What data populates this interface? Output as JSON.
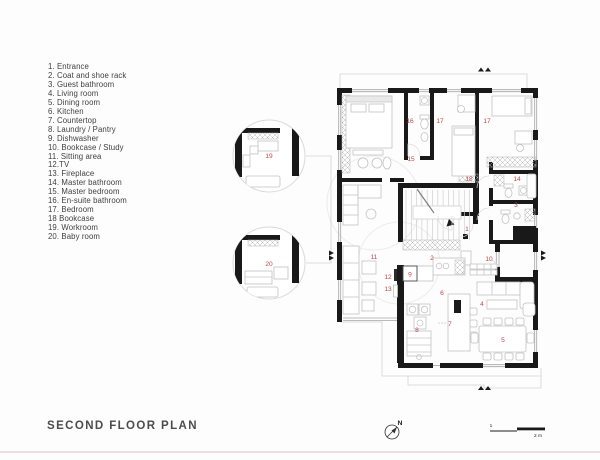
{
  "title": "SECOND FLOOR PLAN",
  "legend": {
    "items": [
      "1. Entrance",
      "2. Coat and shoe rack",
      "3. Guest bathroom",
      "4. Living room",
      "5. Dining room",
      "6. Kitchen",
      "7. Countertop",
      "8. Laundry / Pantry",
      "9. Dishwasher",
      "10. Bookcase / Study",
      "11. Sitting area",
      "12.TV",
      "13. Fireplace",
      "14. Master bathroom",
      "15. Master bedroom",
      "16. En-suite bathroom",
      "17. Bedroom",
      "18 Bookcase",
      "19. Workroom",
      "20. Baby room"
    ]
  },
  "plan": {
    "room_labels": {
      "entrance": "1",
      "coat_rack": "2",
      "guest_bath": "3",
      "living": "4",
      "dining": "5",
      "kitchen": "6",
      "countertop": "7",
      "laundry": "8",
      "dishwasher": "9",
      "bookcase_study": "10",
      "sitting": "11",
      "tv": "12",
      "fireplace": "13",
      "master_bath": "14",
      "master_bed": "15",
      "ensuite": "16",
      "bedroom_a": "17",
      "bedroom_b": "17",
      "bookcase": "18",
      "workroom": "19",
      "baby": "20"
    }
  },
  "compass": {
    "north_label": "N"
  },
  "scale_bar": {
    "start_label": "1",
    "end_label": "2 m"
  },
  "colors": {
    "wall": "#191919",
    "label_red": "#bf4a44",
    "furniture_line": "#c2c2c2",
    "text": "#3f3f3f"
  }
}
